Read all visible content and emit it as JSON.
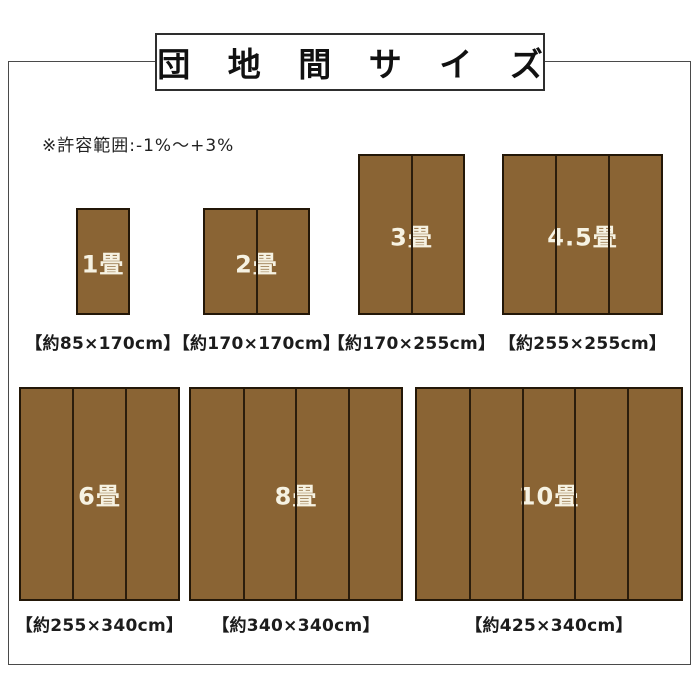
{
  "header": {
    "title": "団 地 間 サ イ ズ"
  },
  "note": "※許容範囲:-1%～+3%",
  "rugs": [
    {
      "name": "1jo",
      "tatami_label": "1畳",
      "size_label": "【約85×170cm】",
      "width_cm": 85,
      "height_cm": 170,
      "panels": 1,
      "row": 1
    },
    {
      "name": "2jo",
      "tatami_label": "2畳",
      "size_label": "【約170×170cm】",
      "width_cm": 170,
      "height_cm": 170,
      "panels": 2,
      "row": 1
    },
    {
      "name": "3jo",
      "tatami_label": "3畳",
      "size_label": "【約170×255cm】",
      "width_cm": 170,
      "height_cm": 255,
      "panels": 2,
      "row": 1
    },
    {
      "name": "4-5jo",
      "tatami_label": "4.5畳",
      "size_label": "【約255×255cm】",
      "width_cm": 255,
      "height_cm": 255,
      "panels": 3,
      "row": 1
    },
    {
      "name": "6jo",
      "tatami_label": "6畳",
      "size_label": "【約255×340cm】",
      "width_cm": 255,
      "height_cm": 340,
      "panels": 3,
      "row": 2
    },
    {
      "name": "8jo",
      "tatami_label": "8畳",
      "size_label": "【約340×340cm】",
      "width_cm": 340,
      "height_cm": 340,
      "panels": 4,
      "row": 2
    },
    {
      "name": "10jo",
      "tatami_label": "10畳",
      "size_label": "【約425×340cm】",
      "width_cm": 425,
      "height_cm": 340,
      "panels": 5,
      "row": 2
    }
  ],
  "colors": {
    "rug_fill": "#8a6434",
    "rug_border": "#231708",
    "rug_divider": "#2b1d0c",
    "rug_label_text": "#f6f2e2",
    "frame_border": "#4a4a4a",
    "title_border": "#2e2e2e"
  }
}
